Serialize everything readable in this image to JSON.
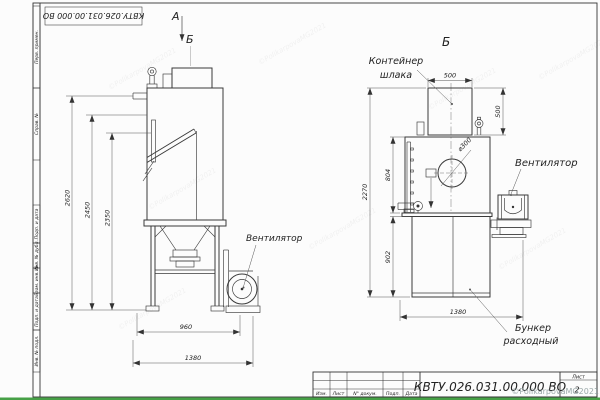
{
  "page": {
    "copyright": "©PolikarpovaMG2021"
  },
  "frame": {
    "top_stamp": "КВТУ.026.031.00.000 ВО",
    "sidebar_labels": [
      "Перв. примен.",
      "Справ. №",
      "Подп. и дата",
      "Инв. № дубл.",
      "Взам. инв. №",
      "Подп. и дата",
      "Инв. № подл."
    ],
    "title_block": {
      "doc_number": "КВТУ.026.031.00.000 ВО",
      "columns": [
        "Изм.",
        "Лист",
        "N° докум.",
        "Подп.",
        "Дата"
      ],
      "sheet_label": "Лист",
      "sheet_number": "2"
    }
  },
  "view_main": {
    "label_a": "А",
    "label_b": "Б",
    "dim_2620": "2620",
    "dim_2450": "2450",
    "dim_2350": "2350",
    "dim_960": "960",
    "dim_1380": "1380",
    "label_fan": "Вентилятор"
  },
  "view_b": {
    "title": "Б",
    "label_container_1": "Контейнер",
    "label_container_2": "шлака",
    "dim_500_w": "500",
    "dim_500_h": "500",
    "dim_dia300": "⌀300",
    "dim_804": "804",
    "dim_2270": "2270",
    "dim_902": "902",
    "dim_1380": "1380",
    "label_fan": "Вентилятор",
    "label_bunker_1": "Бункер",
    "label_bunker_2": "расходный"
  }
}
